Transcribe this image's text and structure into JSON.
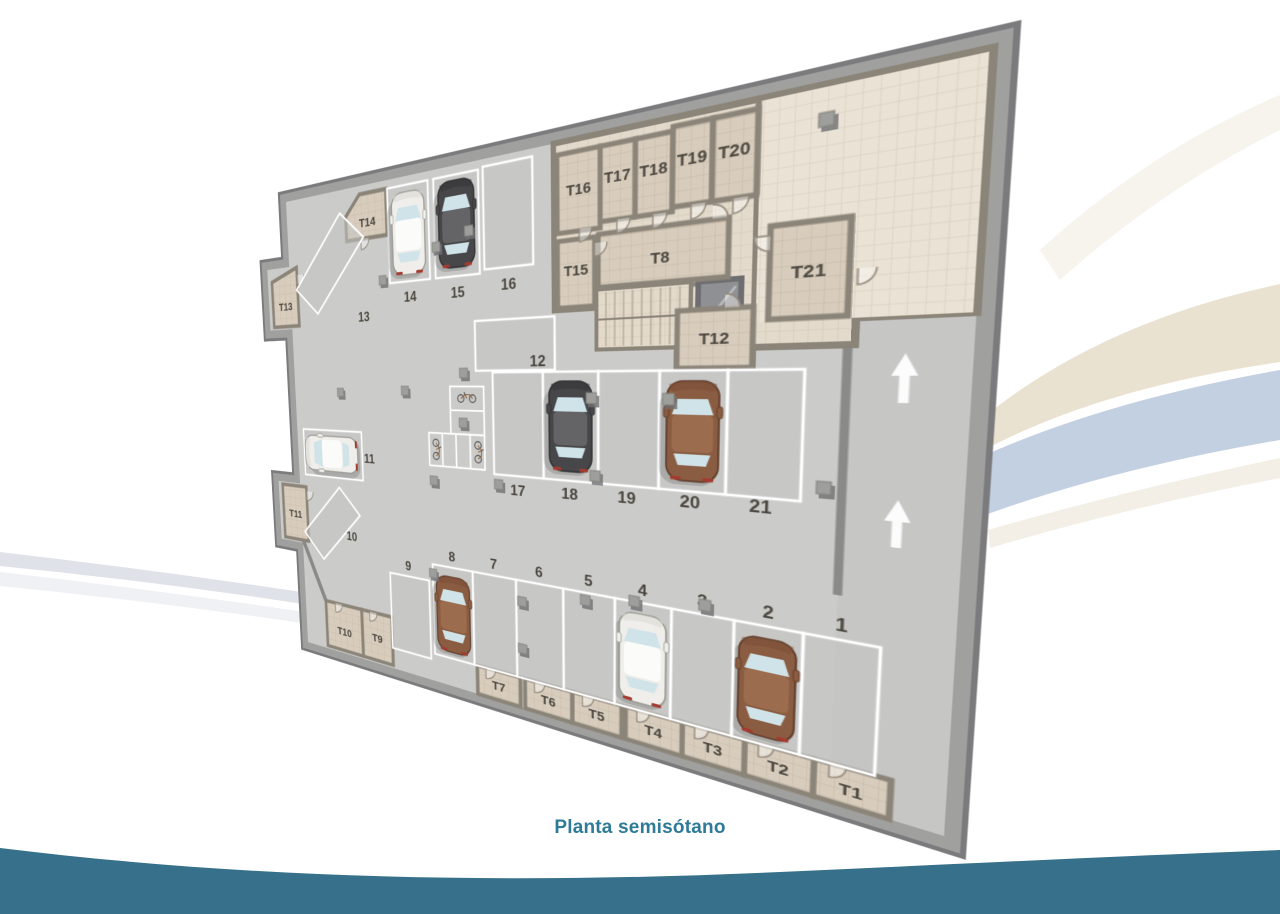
{
  "caption": "Planta semisótano",
  "colors": {
    "caption": "#2e7b97",
    "bottom_wave": "#36708a",
    "band_cream": "#eae2d1",
    "band_blue": "#c3d0e1",
    "band_gray": "#dfe3e9",
    "floor_concrete": "#cbcbc9",
    "wall_outer": "#7b7b7e",
    "wall_inner": "#a0a09e",
    "wall_partition": "#8b8478",
    "bay_line": "#ffffff",
    "label_text": "#4b473f",
    "glass": "#cfe3e9",
    "car_white": "#efeeea",
    "car_dark": "#47474a",
    "car_brown": "#8a5c41"
  },
  "plan": {
    "parking_spaces": [
      {
        "id": "1",
        "car": null
      },
      {
        "id": "2",
        "car": "brown"
      },
      {
        "id": "3",
        "car": null
      },
      {
        "id": "4",
        "car": "white"
      },
      {
        "id": "5",
        "car": null
      },
      {
        "id": "6",
        "car": null
      },
      {
        "id": "7",
        "car": null
      },
      {
        "id": "8",
        "car": "brown"
      },
      {
        "id": "9",
        "car": null
      },
      {
        "id": "10",
        "car": null
      },
      {
        "id": "11",
        "car": "white"
      },
      {
        "id": "12",
        "car": null
      },
      {
        "id": "13",
        "car": null
      },
      {
        "id": "14",
        "car": "white"
      },
      {
        "id": "15",
        "car": "dark"
      },
      {
        "id": "16",
        "car": null
      },
      {
        "id": "17",
        "car": null
      },
      {
        "id": "18",
        "car": "dark"
      },
      {
        "id": "19",
        "car": null
      },
      {
        "id": "20",
        "car": "brown"
      },
      {
        "id": "21",
        "car": null
      }
    ],
    "trasteros": [
      "T1",
      "T2",
      "T3",
      "T4",
      "T5",
      "T6",
      "T7",
      "T8",
      "T9",
      "T10",
      "T11",
      "T12",
      "T13",
      "T14",
      "T15",
      "T16",
      "T17",
      "T18",
      "T19",
      "T20",
      "T21"
    ],
    "bike_racks": {
      "clusters": 2,
      "bikes": 3
    },
    "ramp_arrows": {
      "count": 2,
      "direction": "up"
    },
    "features": [
      "staircase",
      "elevator"
    ]
  }
}
